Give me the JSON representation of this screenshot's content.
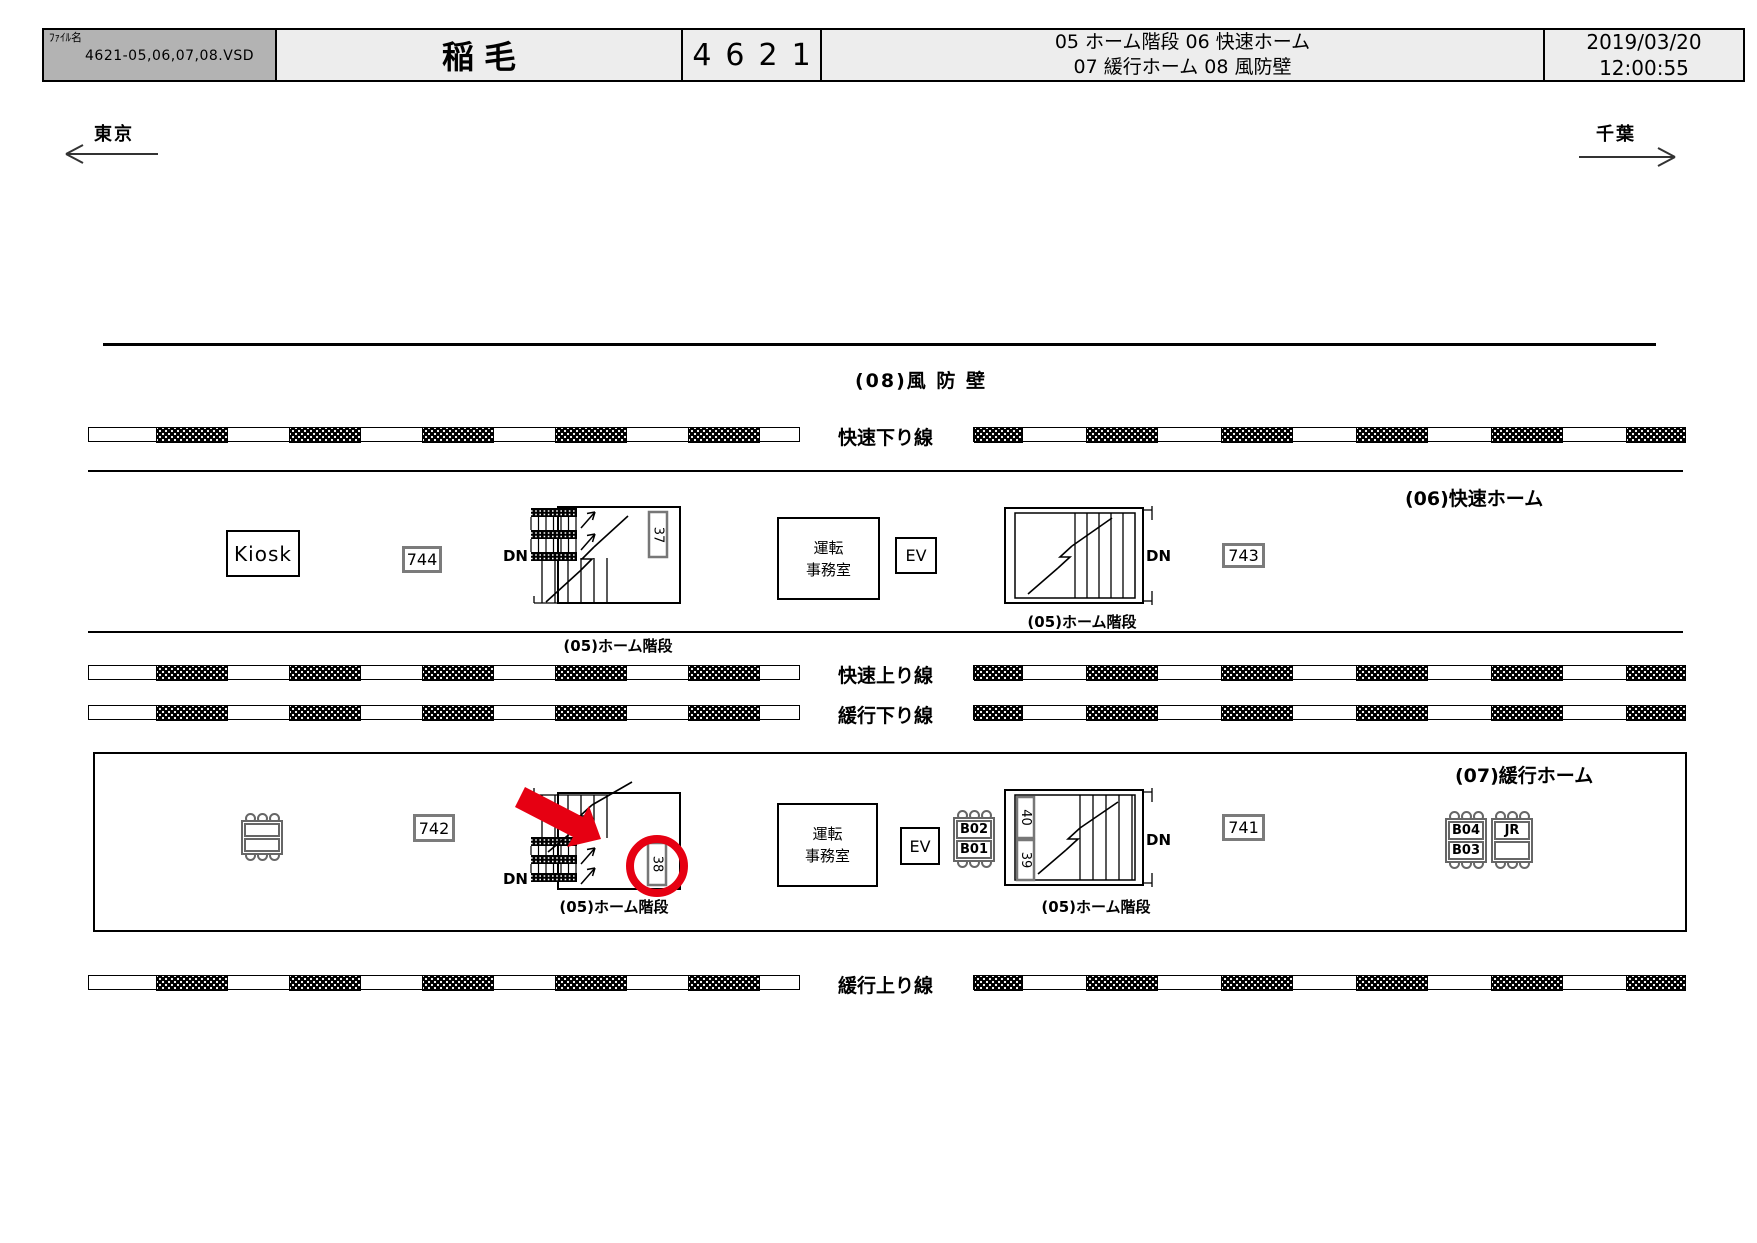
{
  "header": {
    "file_label": "ﾌｧｲﾙ名",
    "file_name": "4621-05,06,07,08.VSD",
    "station_name": "稲毛",
    "sheet_number": "4621",
    "legend_line1": "05 ホーム階段  06 快速ホーム",
    "legend_line2": "07 緩行ホーム  08  風防壁",
    "date": "2019/03/20",
    "time": "12:00:55"
  },
  "directions": {
    "left": "東京",
    "right": "千葉"
  },
  "tracks": {
    "rapid_down": "快速下り線",
    "rapid_up": "快速上り線",
    "local_down": "緩行下り線",
    "local_up": "緩行上り線"
  },
  "areas": {
    "windbreak": "(08)風 防 壁",
    "rapid_platform": "(06)快速ホーム",
    "local_platform": "(07)緩行ホーム",
    "stairs_label": "(05)ホーム階段"
  },
  "facilities": {
    "kiosk": "Kiosk",
    "office_line1": "運転",
    "office_line2": "事務室",
    "elevator": "EV",
    "dn": "DN"
  },
  "equipment": {
    "box_744": "744",
    "box_743": "743",
    "box_742": "742",
    "box_741": "741"
  },
  "stair_numbers": {
    "n37": "37",
    "n38": "38",
    "n39": "39",
    "n40": "40"
  },
  "benches": {
    "b04": "B04",
    "b03": "B03",
    "b02": "B02",
    "b01": "B01",
    "jr": "JR"
  },
  "colors": {
    "annotation_red": "#e60012",
    "header_gray": "#b3b3b3",
    "header_light": "#ededed",
    "outline_gray": "#7b7b7b"
  }
}
